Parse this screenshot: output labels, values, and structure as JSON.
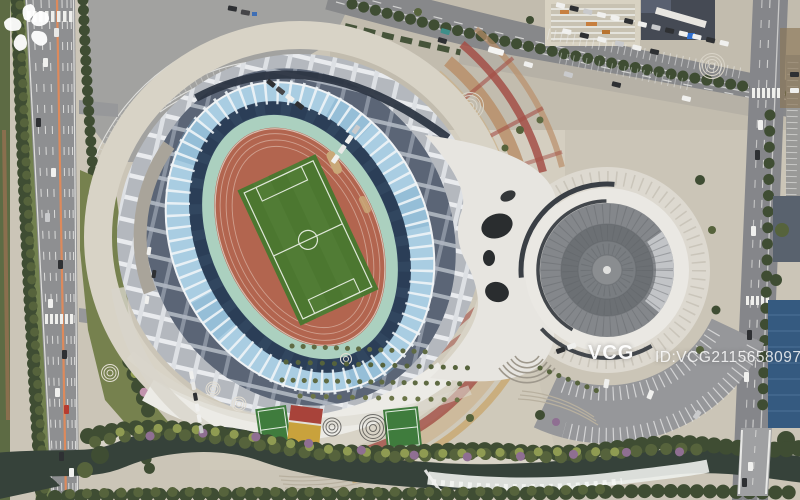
{
  "image": {
    "type": "aerial-drone-photograph",
    "subject": "top-down aerial view of a stadium and circular arena sports complex with surrounding roads, plazas, parking lots and a river"
  },
  "watermark": {
    "brand": "VCG",
    "id_label": "ID:VCG211565809740"
  },
  "palette": {
    "pavement_beige": "#cfc9bb",
    "asphalt": "#8e8f91",
    "parking_asphalt": "#a2a2a0",
    "road_median_orange": "#dd8a5c",
    "roof_gray": "#b4b8be",
    "roof_dark_lattice": "#5b6576",
    "glass_blue": "#a9cde2",
    "bowl_navy": "#31465f",
    "apron_teal": "#abd0bf",
    "track_red": "#b2654f",
    "field_green": "#517c35",
    "dome_gray": "#84878b",
    "plaza_band_red": "#a34f46",
    "plaza_band_tan": "#c8a469",
    "river_water": "#36423a",
    "tree_dark": "#3f4d33",
    "blue_roof": "#355a80"
  },
  "scene": {
    "landmarks": [
      "stadium-with-track-and-field",
      "circular-dome-arena",
      "connector-canopy",
      "left-highway",
      "top-diagonal-road",
      "right-vertical-road-with-bridge",
      "top-left-parking-lot",
      "dome-parking-arc",
      "decorative-plaza-arcs",
      "mini-soccer-courts",
      "riverfront-promenade",
      "river-with-rapids"
    ]
  }
}
